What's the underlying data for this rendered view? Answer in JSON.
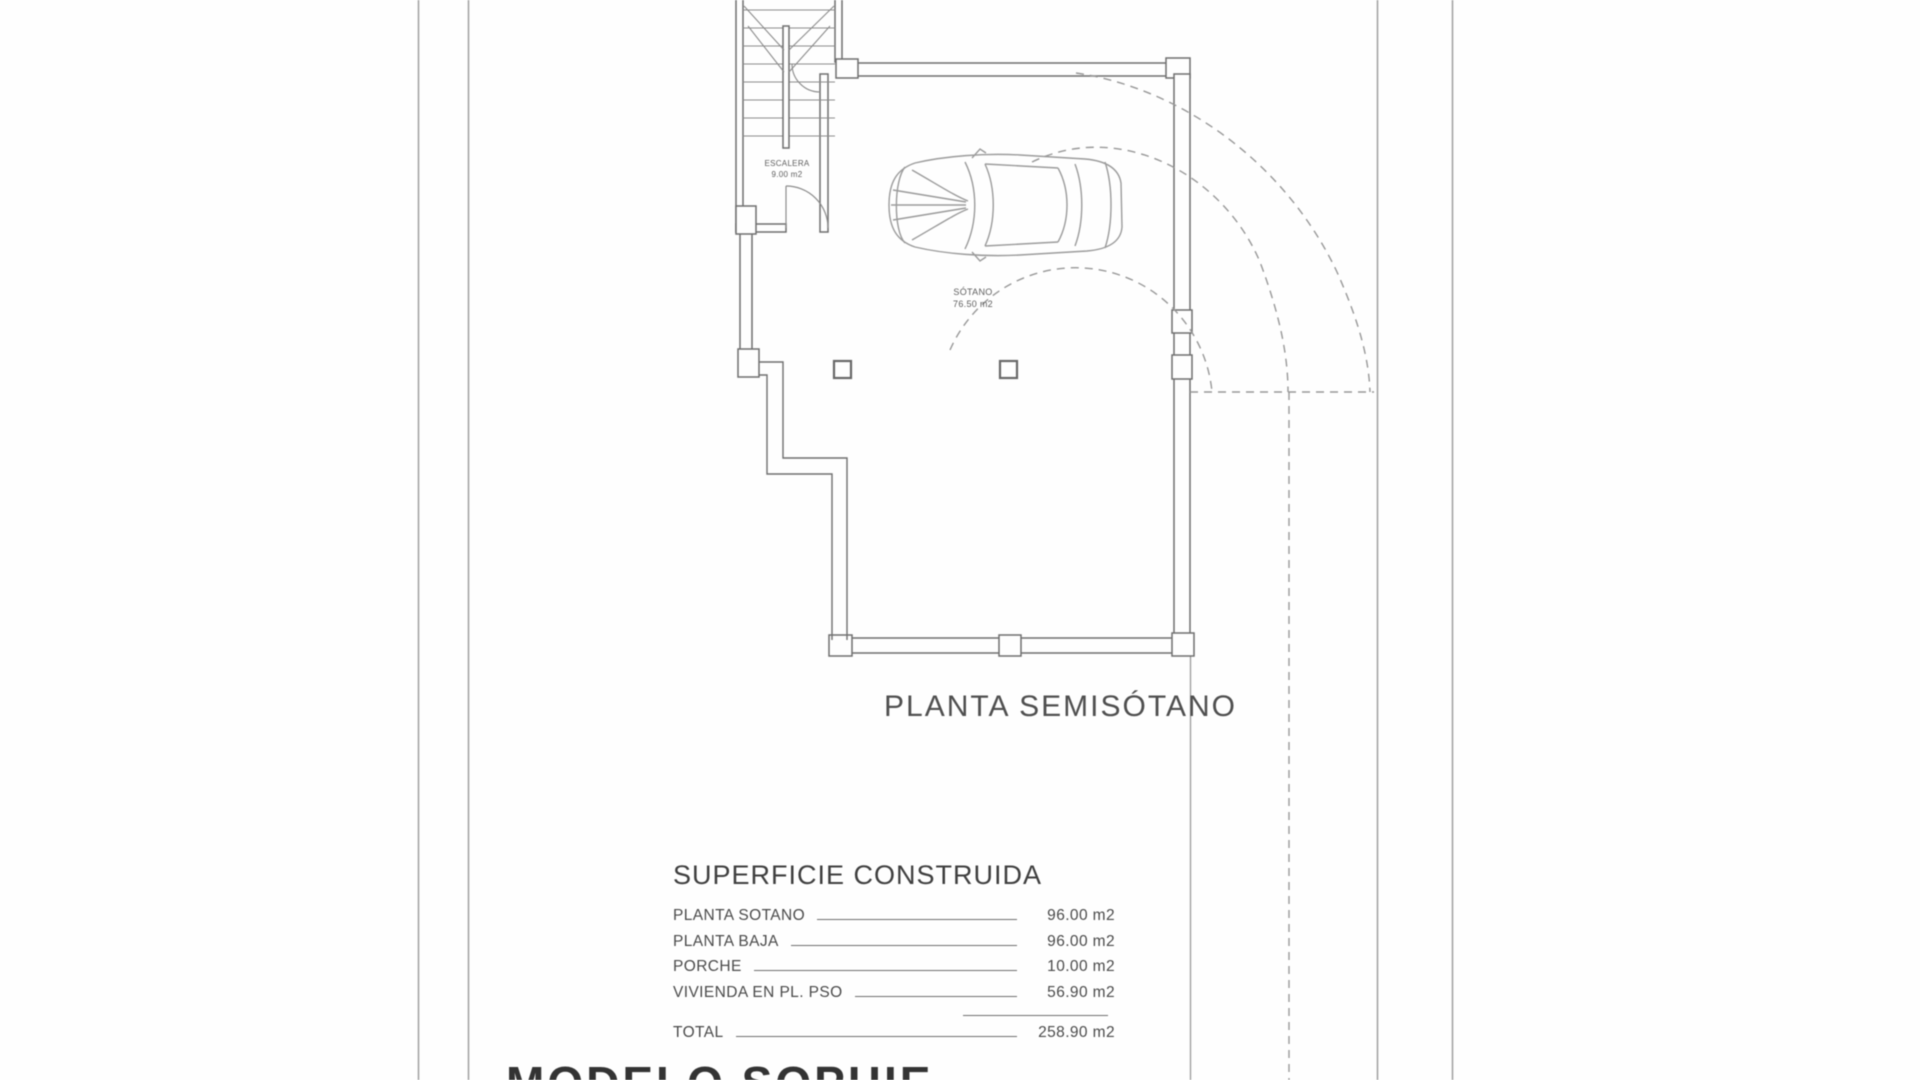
{
  "plan": {
    "floor_title": "PLANTA SEMISÓTANO",
    "stair_room": {
      "name": "ESCALERA",
      "area": "9.00 m2"
    },
    "basement_room": {
      "name": "SÓTANO",
      "area": "76.50 m2"
    }
  },
  "surface_table": {
    "heading": "SUPERFICIE CONSTRUIDA",
    "rows": [
      {
        "label": "PLANTA SOTANO",
        "value": "96.00 m2"
      },
      {
        "label": "PLANTA BAJA",
        "value": "96.00 m2"
      },
      {
        "label": "PORCHE",
        "value": "10.00 m2"
      },
      {
        "label": "VIVIENDA EN PL. PSO",
        "value": "56.90 m2"
      }
    ],
    "total": {
      "label": "TOTAL",
      "value": "258.90 m2"
    }
  },
  "footer": {
    "model_title": "MODELO SOPHIE"
  },
  "colors": {
    "background": "#fefefe",
    "wall_line": "#6f6f6f",
    "detail_line": "#8c8c8c",
    "car_line": "#9b9b9b",
    "dashed_line": "#989898",
    "boundary_line": "#a3a3a3",
    "text": "#4a4a4a"
  }
}
